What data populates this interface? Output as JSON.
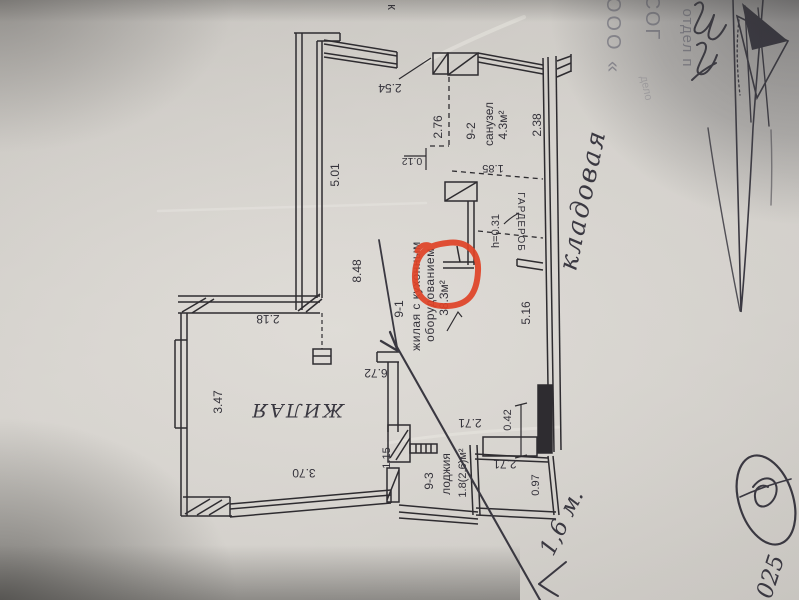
{
  "photo": {
    "kind": "photograph of an apartment floor-plan drawing",
    "red_annotation_color": "#e04327",
    "ink_color": "#2e2c30",
    "pen_color": "#3a3841",
    "stamp_color": "#87868f"
  },
  "labels": {
    "top_cut_letter": "к",
    "d254": "2.54",
    "d501": "5.01",
    "d848": "8.48",
    "d276": "2.76",
    "room2_no": "9-2",
    "room2_name": "санузел",
    "room2_area": "4.3м²",
    "d238": "2.38",
    "d012": "0.12",
    "d185": "1.85",
    "dh031": "h=0.31",
    "wardrobe": "ГАРДЕРОБ",
    "d516": "5.16",
    "room1_no": "9-1",
    "room1_name_l1": "жилая с кухонным",
    "room1_name_l2": "оборудованием",
    "room1_area": "38.3м²",
    "d218": "2.18",
    "d347": "3.47",
    "zhilaya": "ЖИЛАЯ",
    "d370": "3.70",
    "d115": "1.15",
    "d672": "6.72",
    "d271a": "2.71",
    "d042": "0.42",
    "d271b": "2.71",
    "d097": "0.97",
    "room3_no": "9-3",
    "room3_name": "лоджия",
    "room3_area": "1.8(2.6)м²"
  },
  "handwriting": {
    "kladovaya": "кладовая",
    "measure": "1,6 м.",
    "corner_number": "025"
  },
  "stamp": {
    "line1": "ООО «",
    "line2": "СОГ",
    "line3": "отдел п",
    "faint": "дело"
  }
}
